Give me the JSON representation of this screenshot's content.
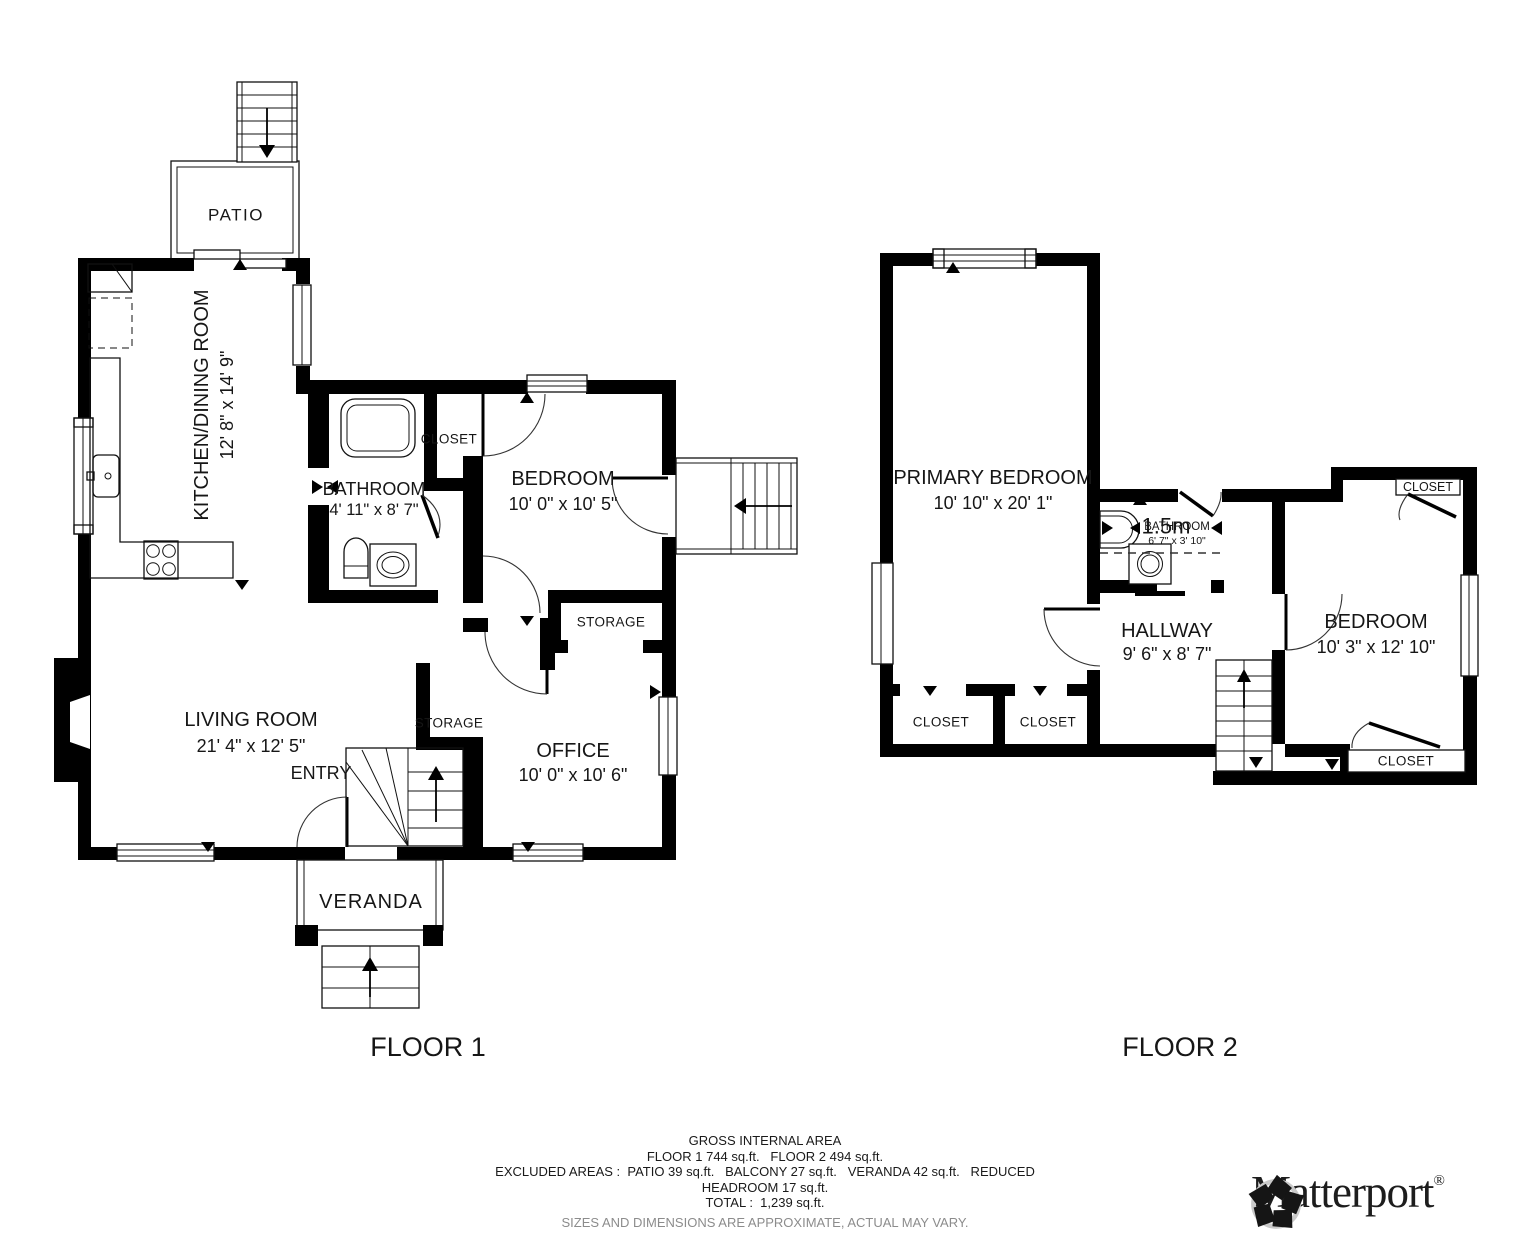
{
  "floor1": {
    "floor_label": "FLOOR 1",
    "patio": "PATIO",
    "kitchen": {
      "name": "KITCHEN/DINING ROOM",
      "dims": "12' 8\" x 14' 9\""
    },
    "bathroom": {
      "name": "BATHROOM",
      "dims": "4' 11\" x 8' 7\""
    },
    "closet": "CLOSET",
    "bedroom": {
      "name": "BEDROOM",
      "dims": "10' 0\" x 10' 5\""
    },
    "storage_upper": "STORAGE",
    "storage_lower": "STORAGE",
    "living_room": {
      "name": "LIVING ROOM",
      "dims": "21' 4\" x 12' 5\""
    },
    "entry": "ENTRY",
    "office": {
      "name": "OFFICE",
      "dims": "10' 0\" x 10' 6\""
    },
    "veranda": "VERANDA"
  },
  "floor2": {
    "floor_label": "FLOOR 2",
    "primary_bedroom": {
      "name": "PRIMARY BEDROOM",
      "dims": "10' 10\" x 20' 1\""
    },
    "bathroom": {
      "headroom": "1.5m",
      "name": "BATHROOM",
      "dims": "6' 7\" x 3' 10\""
    },
    "hallway": {
      "name": "HALLWAY",
      "dims": "9' 6\" x 8' 7\""
    },
    "bedroom": {
      "name": "BEDROOM",
      "dims": "10' 3\" x 12' 10\""
    },
    "closet_left": "CLOSET",
    "closet_right": "CLOSET",
    "closet_top": "CLOSET",
    "closet_bottom": "CLOSET"
  },
  "summary": {
    "line1": "GROSS INTERNAL AREA",
    "line2": "FLOOR 1 744 sq.ft.   FLOOR 2 494 sq.ft.",
    "line3": "EXCLUDED AREAS :  PATIO 39 sq.ft.   BALCONY 27 sq.ft.   VERANDA 42 sq.ft.   REDUCED",
    "line4": "HEADROOM 17 sq.ft.",
    "line5": "TOTAL :  1,239 sq.ft.",
    "disclaimer": "SIZES AND DIMENSIONS ARE APPROXIMATE, ACTUAL MAY VARY."
  },
  "brand": {
    "name": "Matterport",
    "reg": "®"
  },
  "colors": {
    "wall": "#000000",
    "text": "#1a1a1a",
    "muted": "#8c8c8c"
  }
}
